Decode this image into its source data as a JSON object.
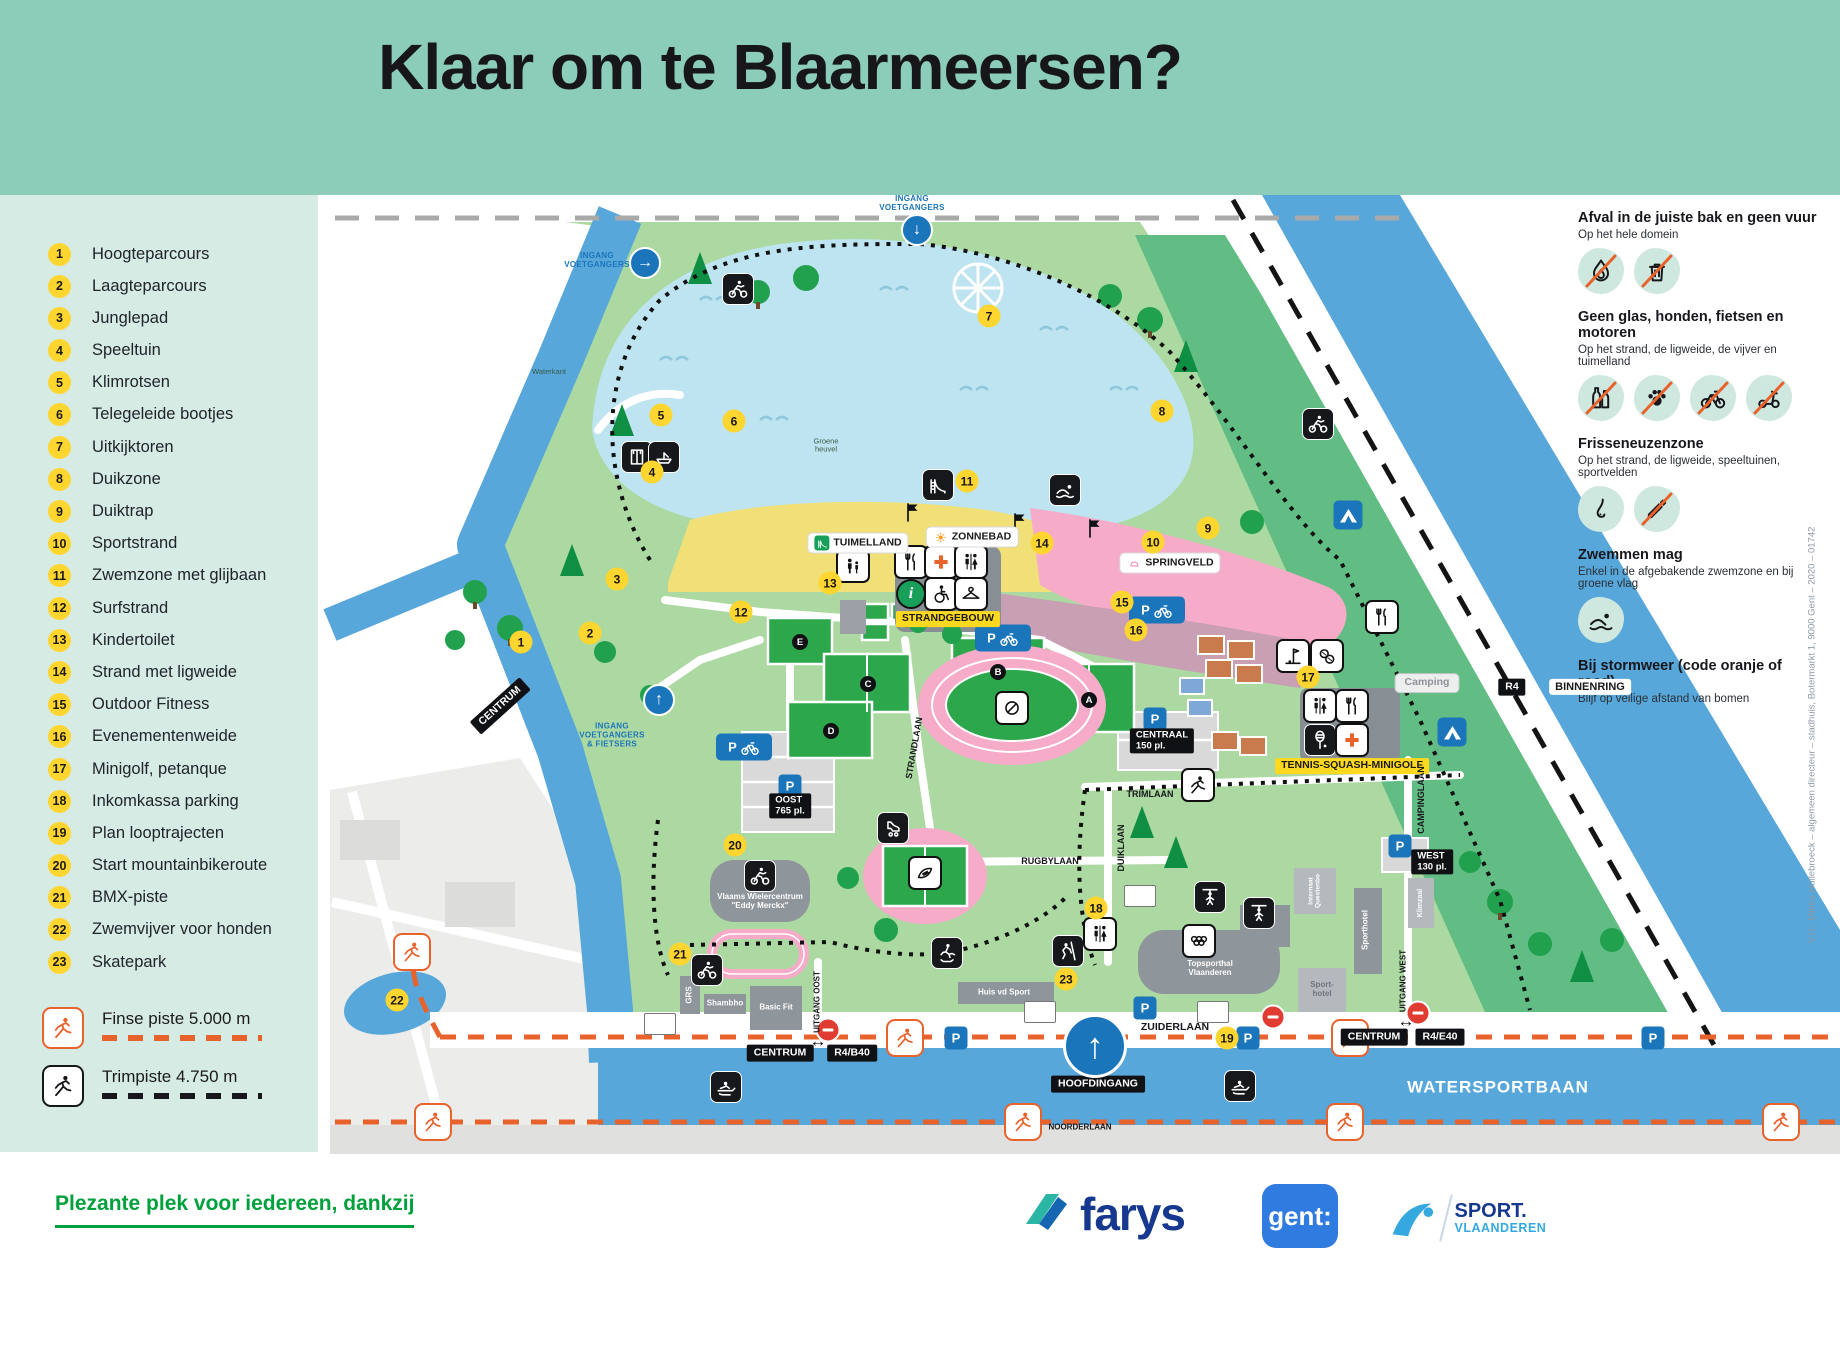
{
  "title": "Klaar om te Blaarmeersen?",
  "legend": {
    "items": [
      {
        "n": 1,
        "label": "Hoogteparcours"
      },
      {
        "n": 2,
        "label": "Laagteparcours"
      },
      {
        "n": 3,
        "label": "Junglepad"
      },
      {
        "n": 4,
        "label": "Speeltuin"
      },
      {
        "n": 5,
        "label": "Klimrotsen"
      },
      {
        "n": 6,
        "label": "Telegeleide bootjes"
      },
      {
        "n": 7,
        "label": "Uitkijktoren"
      },
      {
        "n": 8,
        "label": "Duikzone"
      },
      {
        "n": 9,
        "label": "Duiktrap"
      },
      {
        "n": 10,
        "label": "Sportstrand"
      },
      {
        "n": 11,
        "label": "Zwemzone met glijbaan"
      },
      {
        "n": 12,
        "label": "Surfstrand"
      },
      {
        "n": 13,
        "label": "Kindertoilet"
      },
      {
        "n": 14,
        "label": "Strand met ligweide"
      },
      {
        "n": 15,
        "label": "Outdoor Fitness"
      },
      {
        "n": 16,
        "label": "Evenementenweide"
      },
      {
        "n": 17,
        "label": "Minigolf, petanque"
      },
      {
        "n": 18,
        "label": "Inkomkassa parking"
      },
      {
        "n": 19,
        "label": "Plan looptrajecten"
      },
      {
        "n": 20,
        "label": "Start mountainbikeroute"
      },
      {
        "n": 21,
        "label": "BMX-piste"
      },
      {
        "n": 22,
        "label": "Zwemvijver voor honden"
      },
      {
        "n": 23,
        "label": "Skatepark"
      }
    ]
  },
  "routes": [
    {
      "label": "Finse piste 5.000 m",
      "color": "#E8622C",
      "kind": "runner"
    },
    {
      "label": "Trimpiste 4.750 m",
      "color": "#17171b",
      "kind": "runner"
    }
  ],
  "rules": [
    {
      "title": "Afval in de juiste bak en geen vuur",
      "subtitle": "Op het hele domein",
      "icons": [
        {
          "name": "no-fire-icon",
          "kind": "fire",
          "strike": true
        },
        {
          "name": "no-litter-icon",
          "kind": "trash",
          "strike": true
        }
      ]
    },
    {
      "title": "Geen glas, honden, fietsen en motoren",
      "subtitle": "Op het strand, de ligweide, de vijver en tuimelland",
      "icons": [
        {
          "name": "no-glass-icon",
          "kind": "bottles",
          "strike": true
        },
        {
          "name": "no-dogs-icon",
          "kind": "paw",
          "strike": true
        },
        {
          "name": "no-bikes-icon",
          "kind": "bike",
          "strike": true
        },
        {
          "name": "no-scooters-icon",
          "kind": "scooter",
          "strike": true
        }
      ]
    },
    {
      "title": "Frisseneuzenzone",
      "subtitle": "Op het strand, de ligweide, speeltuinen, sportvelden",
      "icons": [
        {
          "name": "fresh-nose-icon",
          "kind": "nose",
          "strike": false
        },
        {
          "name": "no-smoking-icon",
          "kind": "cigarette",
          "strike": true
        }
      ]
    },
    {
      "title": "Zwemmen mag",
      "subtitle": "Enkel in de afgebakende zwemzone en bij groene vlag",
      "icons": [
        {
          "name": "swimmer-icon",
          "kind": "swimmer",
          "strike": false
        }
      ]
    },
    {
      "title": "Bij stormweer (code oranje of rood)",
      "subtitle": "Blijf op veilige afstand van bomen",
      "icons": []
    }
  ],
  "map": {
    "markers": [
      {
        "n": 1,
        "x": 521,
        "y": 642
      },
      {
        "n": 2,
        "x": 590,
        "y": 633
      },
      {
        "n": 3,
        "x": 617,
        "y": 579
      },
      {
        "n": 4,
        "x": 652,
        "y": 472
      },
      {
        "n": 5,
        "x": 661,
        "y": 415
      },
      {
        "n": 6,
        "x": 734,
        "y": 421
      },
      {
        "n": 7,
        "x": 989,
        "y": 316
      },
      {
        "n": 8,
        "x": 1162,
        "y": 411
      },
      {
        "n": 9,
        "x": 1208,
        "y": 528
      },
      {
        "n": 10,
        "x": 1153,
        "y": 542
      },
      {
        "n": 11,
        "x": 967,
        "y": 481
      },
      {
        "n": 12,
        "x": 741,
        "y": 612
      },
      {
        "n": 13,
        "x": 830,
        "y": 583
      },
      {
        "n": 14,
        "x": 1042,
        "y": 543
      },
      {
        "n": 15,
        "x": 1122,
        "y": 602
      },
      {
        "n": 16,
        "x": 1136,
        "y": 630
      },
      {
        "n": 17,
        "x": 1308,
        "y": 677
      },
      {
        "n": 18,
        "x": 1096,
        "y": 908
      },
      {
        "n": 19,
        "x": 1227,
        "y": 1038
      },
      {
        "n": 20,
        "x": 735,
        "y": 845
      },
      {
        "n": 21,
        "x": 680,
        "y": 954
      },
      {
        "n": 22,
        "x": 397,
        "y": 1000
      },
      {
        "n": 23,
        "x": 1066,
        "y": 979
      }
    ],
    "field_letters": [
      {
        "l": "E",
        "x": 800,
        "y": 642
      },
      {
        "l": "C",
        "x": 868,
        "y": 684
      },
      {
        "l": "D",
        "x": 831,
        "y": 731
      },
      {
        "l": "B",
        "x": 998,
        "y": 672
      },
      {
        "l": "A",
        "x": 1089,
        "y": 700
      }
    ],
    "labels": [
      {
        "t": "TUIMELLAND",
        "x": 858,
        "y": 543,
        "s": "wbox",
        "ic": "slide",
        "icbg": "#18A05A",
        "iccol": "#fff"
      },
      {
        "t": "ZONNEBAD",
        "x": 972,
        "y": 537,
        "s": "wbox",
        "ic": "sun",
        "icbg": "#fff",
        "iccol": "#F59A23"
      },
      {
        "t": "SPRINGVELD",
        "x": 1170,
        "y": 563,
        "s": "wbox",
        "ic": "spring",
        "icbg": "#fff",
        "iccol": "#E85A9B"
      },
      {
        "t": "STRANDGEBOUW",
        "x": 948,
        "y": 619,
        "s": "ybox"
      },
      {
        "t": "TENNIS-SQUASH-MINIGOLF",
        "x": 1352,
        "y": 766,
        "s": "ybox"
      },
      {
        "t": "Camping",
        "x": 1427,
        "y": 683,
        "s": "gbox"
      },
      {
        "t": "CENTRUM",
        "x": 500,
        "y": 706,
        "s": "bbox",
        "r": -42
      },
      {
        "t": "CENTRUM",
        "x": 780,
        "y": 1053,
        "s": "bbox"
      },
      {
        "t": "R4/B40",
        "x": 852,
        "y": 1053,
        "s": "bbox"
      },
      {
        "t": "CENTRUM",
        "x": 1374,
        "y": 1037,
        "s": "bbox"
      },
      {
        "t": "R4/E40",
        "x": 1440,
        "y": 1037,
        "s": "bbox"
      },
      {
        "t": "HOOFDINGANG",
        "x": 1098,
        "y": 1084,
        "s": "bbox"
      },
      {
        "t": "R4",
        "x": 1512,
        "y": 687,
        "s": "bbox"
      },
      {
        "t": "BINNENRING",
        "x": 1590,
        "y": 687,
        "s": "wboxp"
      },
      {
        "t": "CENTRAAL\n150 pl.",
        "x": 1162,
        "y": 741,
        "s": "bbox2"
      },
      {
        "t": "OOST\n765 pl.",
        "x": 790,
        "y": 806,
        "s": "bbox2"
      },
      {
        "t": "WEST\n130 pl.",
        "x": 1432,
        "y": 862,
        "s": "bbox2"
      },
      {
        "t": "ZUIDERLAAN",
        "x": 1175,
        "y": 1028,
        "s": "street"
      },
      {
        "t": "RUGBYLAAN",
        "x": 1050,
        "y": 861,
        "s": "street",
        "f": 9
      },
      {
        "t": "TRIMLAAN",
        "x": 1150,
        "y": 794,
        "s": "street",
        "f": 9
      },
      {
        "t": "NOORDERLAAN",
        "x": 1080,
        "y": 1128,
        "s": "street",
        "f": 8
      },
      {
        "t": "DUIKLAAN",
        "x": 1121,
        "y": 848,
        "s": "street",
        "r": -90,
        "f": 9
      },
      {
        "t": "CAMPINGLAAN",
        "x": 1421,
        "y": 800,
        "s": "street",
        "r": -90,
        "f": 9
      },
      {
        "t": "STRANDLAAN",
        "x": 914,
        "y": 748,
        "s": "street",
        "r": -80,
        "f": 9
      },
      {
        "t": "UITGANG OOST",
        "x": 818,
        "y": 1002,
        "s": "street",
        "r": -90,
        "f": 8
      },
      {
        "t": "UITGANG WEST",
        "x": 1404,
        "y": 981,
        "s": "street",
        "r": -90,
        "f": 8
      },
      {
        "t": "WATERSPORTBAAN",
        "x": 1498,
        "y": 1087,
        "s": "wtext"
      },
      {
        "t": "Groene\nheuvel",
        "x": 826,
        "y": 446,
        "s": "tiny"
      },
      {
        "t": "Waterkant",
        "x": 549,
        "y": 372,
        "s": "tiny"
      },
      {
        "t": "Vlaams Wielercentrum\n\"Eddy Merckx\"",
        "x": 760,
        "y": 902,
        "s": "bldg"
      },
      {
        "t": "Topsporthal\nVlaanderen",
        "x": 1210,
        "y": 969,
        "s": "bldg"
      },
      {
        "t": "Sport-\nhotel",
        "x": 1322,
        "y": 990,
        "s": "bldg2"
      },
      {
        "t": "Basic Fit",
        "x": 776,
        "y": 1008,
        "s": "bldg"
      },
      {
        "t": "Shambho",
        "x": 725,
        "y": 1004,
        "s": "bldg"
      },
      {
        "t": "Huis vd Sport",
        "x": 1004,
        "y": 993,
        "s": "bldg"
      },
      {
        "t": "GRS",
        "x": 690,
        "y": 995,
        "s": "bldg",
        "r": -90
      },
      {
        "t": "Sporthotel",
        "x": 1366,
        "y": 930,
        "s": "bldg",
        "r": -90
      },
      {
        "t": "Klimzaal",
        "x": 1421,
        "y": 903,
        "s": "bldg",
        "r": -90,
        "f": 7
      },
      {
        "t": "Internaat\nQuestenbo",
        "x": 1315,
        "y": 891,
        "s": "bldg",
        "r": -90,
        "f": 6.5
      },
      {
        "t": "INGANG\nVOETGANGERS",
        "x": 597,
        "y": 261,
        "s": "blue"
      },
      {
        "t": "INGANG\nVOETGANGERS",
        "x": 912,
        "y": 204,
        "s": "blue"
      },
      {
        "t": "INGANG\nVOETGANGERS\n& FIETSERS",
        "x": 612,
        "y": 736,
        "s": "blue"
      },
      {
        "t": "↔",
        "x": 818,
        "y": 1041,
        "s": "arrow"
      },
      {
        "t": "↔",
        "x": 1406,
        "y": 1021,
        "s": "arrow"
      },
      {
        "t": "←",
        "x": 472,
        "y": 733,
        "s": "warrow",
        "r": -42
      }
    ],
    "icons": [
      {
        "n": "mountainbike-route-icon",
        "k": "cyclist",
        "v": "dark",
        "x": 738,
        "y": 289
      },
      {
        "n": "mountainbike-route-icon",
        "k": "cyclist",
        "v": "dark",
        "x": 1318,
        "y": 424
      },
      {
        "n": "beach-cabins-icon",
        "k": "cabins",
        "v": "dark",
        "x": 637,
        "y": 457
      },
      {
        "n": "boats-icon",
        "k": "boat",
        "v": "dark",
        "x": 664,
        "y": 457
      },
      {
        "n": "waterslide-icon",
        "k": "slide",
        "v": "dark",
        "x": 938,
        "y": 485
      },
      {
        "n": "swim-zone-icon",
        "k": "swimmer",
        "v": "dark",
        "x": 1065,
        "y": 490
      },
      {
        "n": "playground-icon",
        "k": "family",
        "v": "white",
        "x": 853,
        "y": 566
      },
      {
        "n": "roller-skate-icon",
        "k": "rollerskate",
        "v": "dark",
        "x": 893,
        "y": 828
      },
      {
        "n": "skateboard-icon",
        "k": "skateboarder",
        "v": "dark",
        "x": 947,
        "y": 953
      },
      {
        "n": "bmx-icon",
        "k": "cyclist",
        "v": "dark",
        "x": 707,
        "y": 970
      },
      {
        "n": "cycling-centre-icon",
        "k": "cyclist",
        "v": "dark",
        "x": 760,
        "y": 876
      },
      {
        "n": "climbing-icon",
        "k": "climber",
        "v": "dark",
        "x": 1068,
        "y": 951
      },
      {
        "n": "gymnastics-icon",
        "k": "gymnast",
        "v": "dark",
        "x": 1210,
        "y": 897
      },
      {
        "n": "gymnastics-icon",
        "k": "gymnast",
        "v": "dark",
        "x": 1259,
        "y": 913
      },
      {
        "n": "rowing-icon",
        "k": "rower",
        "v": "dark",
        "x": 726,
        "y": 1087
      },
      {
        "n": "rowing-icon",
        "k": "rower",
        "v": "dark",
        "x": 1240,
        "y": 1086
      },
      {
        "n": "trimpiste-icon",
        "k": "runner",
        "v": "white",
        "x": 1198,
        "y": 785
      },
      {
        "n": "wc-icon",
        "k": "wc",
        "v": "white",
        "x": 1100,
        "y": 934
      },
      {
        "n": "wc-icon",
        "k": "wc",
        "v": "white",
        "x": 1320,
        "y": 706
      },
      {
        "n": "restaurant-icon",
        "k": "cutlery",
        "v": "white",
        "x": 1352,
        "y": 706
      },
      {
        "n": "squash-icon",
        "k": "squash",
        "v": "dark",
        "x": 1320,
        "y": 740
      },
      {
        "n": "first-aid-icon",
        "k": "cross",
        "v": "white",
        "x": 1352,
        "y": 740
      },
      {
        "n": "restaurant-icon",
        "k": "cutlery",
        "v": "white",
        "x": 1382,
        "y": 617
      },
      {
        "n": "minigolf-icon",
        "k": "minigolf",
        "v": "white",
        "x": 1293,
        "y": 656
      },
      {
        "n": "petanque-icon",
        "k": "petanque",
        "v": "white",
        "x": 1327,
        "y": 656
      },
      {
        "n": "olympic-rings-icon",
        "k": "rings",
        "v": "white",
        "x": 1199,
        "y": 941
      },
      {
        "n": "restaurant-icon",
        "k": "cutlery",
        "v": "white",
        "x": 911,
        "y": 562
      },
      {
        "n": "first-aid-icon",
        "k": "cross",
        "v": "white",
        "x": 941,
        "y": 562
      },
      {
        "n": "wc-icon",
        "k": "wc",
        "v": "white",
        "x": 971,
        "y": 562
      },
      {
        "n": "info-icon",
        "k": "info",
        "v": "info",
        "x": 911,
        "y": 594,
        "l": "i"
      },
      {
        "n": "wheelchair-icon",
        "k": "wheelchair",
        "v": "white",
        "x": 941,
        "y": 594
      },
      {
        "n": "cloakroom-icon",
        "k": "hanger",
        "v": "white",
        "x": 971,
        "y": 594
      },
      {
        "n": "rugby-icon",
        "k": "rugby",
        "v": "white",
        "x": 925,
        "y": 873
      },
      {
        "n": "athletics-icon",
        "k": "discus",
        "v": "white",
        "x": 1012,
        "y": 708
      },
      {
        "n": "camping-icon",
        "k": "tent",
        "v": "tent",
        "x": 1348,
        "y": 515
      },
      {
        "n": "camping-icon",
        "k": "tent",
        "v": "tent",
        "x": 1452,
        "y": 732
      },
      {
        "n": "flag-icon",
        "k": "flag",
        "v": "plain",
        "x": 913,
        "y": 512
      },
      {
        "n": "flag-icon",
        "k": "flag",
        "v": "plain",
        "x": 1020,
        "y": 522
      },
      {
        "n": "flag-icon",
        "k": "flag",
        "v": "plain",
        "x": 1095,
        "y": 528
      },
      {
        "n": "finse-piste-icon",
        "k": "runner",
        "v": "orange",
        "x": 412,
        "y": 952
      },
      {
        "n": "finse-piste-icon",
        "k": "runner",
        "v": "orange",
        "x": 905,
        "y": 1038
      },
      {
        "n": "finse-piste-icon",
        "k": "runner",
        "v": "orange",
        "x": 1350,
        "y": 1038
      },
      {
        "n": "finse-piste-icon",
        "k": "runner",
        "v": "orange",
        "x": 1023,
        "y": 1122
      },
      {
        "n": "finse-piste-icon",
        "k": "runner",
        "v": "orange",
        "x": 1345,
        "y": 1122
      },
      {
        "n": "finse-piste-icon",
        "k": "runner",
        "v": "orange",
        "x": 1781,
        "y": 1122
      },
      {
        "n": "finse-piste-icon",
        "k": "runner",
        "v": "orange",
        "x": 433,
        "y": 1122
      },
      {
        "n": "parking-icon",
        "k": "p",
        "v": "p",
        "x": 956,
        "y": 1038,
        "l": "P"
      },
      {
        "n": "parking-icon",
        "k": "p",
        "v": "p",
        "x": 1248,
        "y": 1038,
        "l": "P"
      },
      {
        "n": "parking-icon",
        "k": "p",
        "v": "p",
        "x": 1145,
        "y": 1008,
        "l": "P"
      },
      {
        "n": "parking-icon",
        "k": "p",
        "v": "p",
        "x": 1155,
        "y": 719,
        "l": "P"
      },
      {
        "n": "parking-icon",
        "k": "p",
        "v": "p",
        "x": 790,
        "y": 786,
        "l": "P"
      },
      {
        "n": "parking-icon",
        "k": "p",
        "v": "p",
        "x": 1400,
        "y": 846,
        "l": "P"
      },
      {
        "n": "parking-icon",
        "k": "p",
        "v": "p",
        "x": 1653,
        "y": 1038,
        "l": "P"
      },
      {
        "n": "bike-parking-icon",
        "k": "pbike",
        "v": "pbike",
        "x": 1003,
        "y": 638,
        "l": "P"
      },
      {
        "n": "bike-parking-icon",
        "k": "pbike",
        "v": "pbike",
        "x": 1157,
        "y": 610,
        "l": "P"
      },
      {
        "n": "bike-parking-icon",
        "k": "pbike",
        "v": "pbike",
        "x": 744,
        "y": 747,
        "l": "P"
      },
      {
        "n": "no-entry-icon",
        "k": "noentry",
        "v": "noentry",
        "x": 828,
        "y": 1030
      },
      {
        "n": "no-entry-icon",
        "k": "noentry",
        "v": "noentry",
        "x": 1273,
        "y": 1017
      },
      {
        "n": "no-entry-icon",
        "k": "noentry",
        "v": "noentry",
        "x": 1418,
        "y": 1013
      },
      {
        "n": "bus-stop-icon",
        "k": "bus",
        "v": "bus",
        "x": 660,
        "y": 1024
      },
      {
        "n": "bus-stop-icon",
        "k": "bus",
        "v": "bus",
        "x": 1040,
        "y": 1012
      },
      {
        "n": "bus-stop-icon",
        "k": "bus",
        "v": "bus",
        "x": 1140,
        "y": 896
      },
      {
        "n": "bus-stop-icon",
        "k": "bus",
        "v": "bus",
        "x": 1213,
        "y": 1012
      },
      {
        "n": "entrance-arrow-icon",
        "k": "gate",
        "v": "gate",
        "x": 645,
        "y": 263,
        "l": "→"
      },
      {
        "n": "entrance-arrow-icon",
        "k": "gate",
        "v": "gate",
        "x": 917,
        "y": 230,
        "l": "↓"
      },
      {
        "n": "entrance-arrow-icon",
        "k": "gate",
        "v": "gate",
        "x": 659,
        "y": 700,
        "l": "↑"
      },
      {
        "n": "main-entrance-icon",
        "k": "gate",
        "v": "biggate",
        "x": 1095,
        "y": 1046,
        "l": "↑"
      }
    ]
  },
  "footer": {
    "tagline": "Plezante plek voor iedereen, dankzij",
    "farys": "farys",
    "gent": "gent:",
    "sport_line1": "SPORT.",
    "sport_line2": "VLAANDEREN"
  },
  "credit": "V.U.: Mieke Hullebroeck – algemeen directeur – stadhuis, Botermarkt 1, 9000 Gent – 2020 – 01742"
}
